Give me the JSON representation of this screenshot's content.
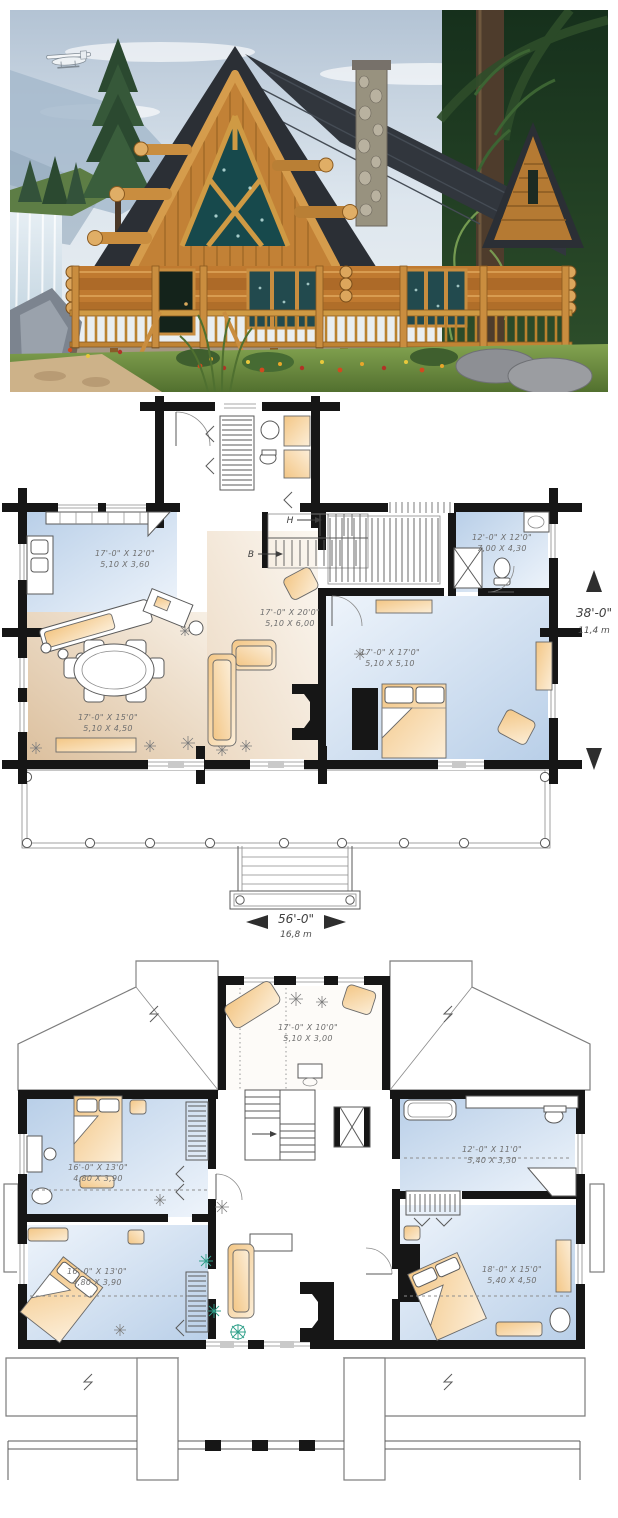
{
  "photo": {
    "name": "log-home-exterior-rendering"
  },
  "floor1": {
    "rooms": {
      "kitchen": {
        "imperial": "17'-0\" X 12'0\"",
        "metric": "5,10 X 3,60"
      },
      "dining": {
        "imperial": "17'-0\" X 15'0\"",
        "metric": "5,10 X 4,50"
      },
      "living": {
        "imperial": "17'-0\" X 20'0\"",
        "metric": "5,10 X 6,00"
      },
      "bedroom": {
        "imperial": "17'-0\" X 17'0\"",
        "metric": "5,10 X 5,10"
      },
      "bath": {
        "imperial": "12'-0\" X 12'0\"",
        "metric": "7,00 X 4,30"
      }
    },
    "stairs": {
      "up": "H",
      "down": "B"
    },
    "dim_depth": {
      "imperial": "38'-0\"",
      "metric": "11,4 m"
    },
    "dim_width": {
      "imperial": "56'-0\"",
      "metric": "16,8 m"
    }
  },
  "floor2": {
    "rooms": {
      "sitting": {
        "imperial": "17'-0\" X 10'0\"",
        "metric": "5,10 X 3,00"
      },
      "bedroom_left_upper": {
        "imperial": "16'-0\" X 13'0\"",
        "metric": "4,80 X 3,90"
      },
      "bedroom_left_lower": {
        "imperial": "16'-0\" X 13'0\"",
        "metric": "4,80 X 3,90"
      },
      "bath": {
        "imperial": "12'-0\" X 11'0\"",
        "metric": "5,40 X 3,30"
      },
      "bedroom_right": {
        "imperial": "18'-0\" X 15'0\"",
        "metric": "5,40 X 4,50"
      }
    }
  },
  "colors": {
    "wall": "#161616",
    "room_blue": "#c7d8ec",
    "room_tan": "#e5d0b4",
    "furniture": "#f4cd92",
    "label_text": "#6f6f6f",
    "roof_dark": "#2d3137",
    "log_wood": "#c07c32"
  }
}
